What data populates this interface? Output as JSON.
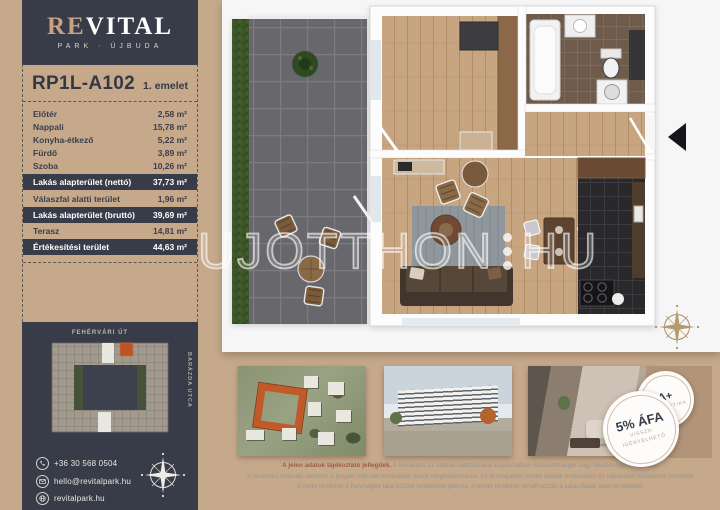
{
  "brand": {
    "name_accent": "RE",
    "name_rest": "VITAL",
    "subtitle": "PARK · ÚJBUDA"
  },
  "unit": {
    "id": "RP1L-A102",
    "floor": "1. emelet"
  },
  "areas": {
    "rows": [
      {
        "label": "Előtér",
        "value": "2,58 m²",
        "highlight": false
      },
      {
        "label": "Nappali",
        "value": "15,78 m²",
        "highlight": false
      },
      {
        "label": "Konyha-étkező",
        "value": "5,22 m²",
        "highlight": false
      },
      {
        "label": "Fürdő",
        "value": "3,89 m²",
        "highlight": false
      },
      {
        "label": "Szoba",
        "value": "10,26 m²",
        "highlight": false
      },
      {
        "label": "Lakás alapterület (nettó)",
        "value": "37,73 m²",
        "highlight": true
      },
      {
        "label": "Válaszfal alatti terület",
        "value": "1,96 m²",
        "highlight": false
      },
      {
        "label": "Lakás alapterület (bruttó)",
        "value": "39,69 m²",
        "highlight": true
      },
      {
        "label": "Terasz",
        "value": "14,81 m²",
        "highlight": false
      },
      {
        "label": "Értékesítési terület",
        "value": "44,63 m²",
        "highlight": true
      }
    ]
  },
  "siteplan": {
    "street_top": "FEHÉRVÁRI ÚT",
    "street_right": "BARÁZDA UTCA"
  },
  "contact": {
    "phone": "+36 30 568 0504",
    "email": "hello@revitalpark.hu",
    "website": "revitalpark.hu"
  },
  "watermark": {
    "left": "UJOTTHON",
    "right": "HU"
  },
  "badges": {
    "energy": {
      "title": "A+",
      "subtitle": "ENERGETIKA"
    },
    "vat": {
      "title": "5% ÁFA",
      "line1": "VISSZA-",
      "line2": "IGÉNYELHETŐ"
    }
  },
  "disclaimer": {
    "line1_bold": "A jelen adatok tájékoztató jellegűek.",
    "line1_rest": " A Beruházó az adatok változásával kapcsolatban kötelezettséget vagy felelősséget nem vállal.",
    "line2": "A részletes műszaki tartalom a projekt műszaki leírásában került meghatározásra. Az itt megadott terület adatok burkolatlan és vakolatlan felületekre értendők.",
    "line3": "A nettó területek a helyiségek falai közötti területeket jelentik. A bruttó területek tartalmazzák a válaszfalak alatti területeket."
  },
  "colors": {
    "accent_tan": "#c8a184",
    "dark_navy": "#383c49",
    "highlight_orange": "#b5542a"
  }
}
